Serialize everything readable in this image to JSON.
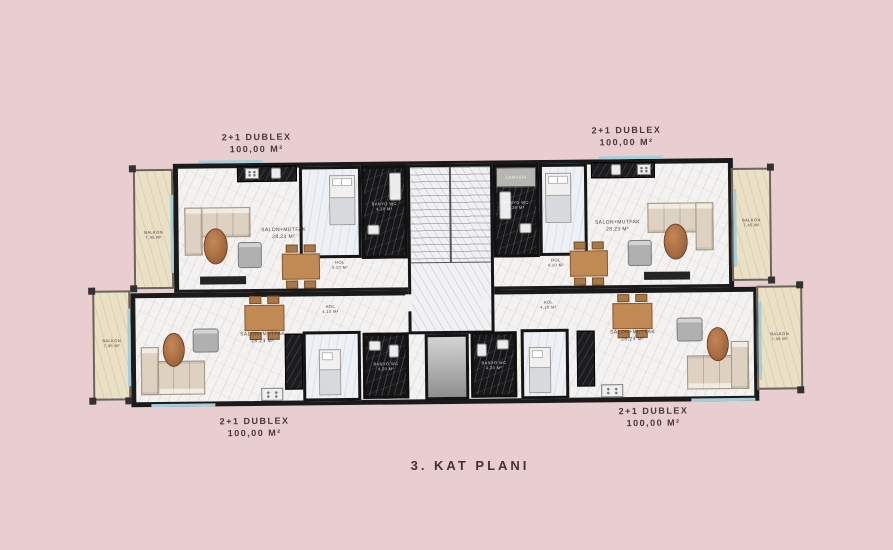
{
  "plan_title": "3. KAT PLANI",
  "units": {
    "top_left": {
      "type": "2+1 DUBLEX",
      "area": "100,00 M²"
    },
    "top_right": {
      "type": "2+1 DUBLEX",
      "area": "100,00 M²"
    },
    "bottom_left": {
      "type": "2+1 DUBLEX",
      "area": "100,00 M²"
    },
    "bottom_right": {
      "type": "2+1 DUBLEX",
      "area": "100,00 M²"
    }
  },
  "rooms": {
    "salon": {
      "name": "SALON+MUTFAK",
      "area": "28,23 M²"
    },
    "hol": {
      "name": "HOL",
      "area": "4,10 M²"
    },
    "balkon": {
      "name": "BALKON",
      "area": "7,45 M²"
    },
    "banyo": {
      "name": "BANYO WC",
      "area": "4,20 M²"
    },
    "camasir": "ÇAMAŞIR"
  },
  "colors": {
    "background": "#e8ced1",
    "wall": "#1a1a1a",
    "floor_marble": "#f4f2f0",
    "black_marble": "#17171a",
    "balcony_stone": "#e9e0c6",
    "wood": "#a9683e",
    "label_text": "#4b3737"
  }
}
